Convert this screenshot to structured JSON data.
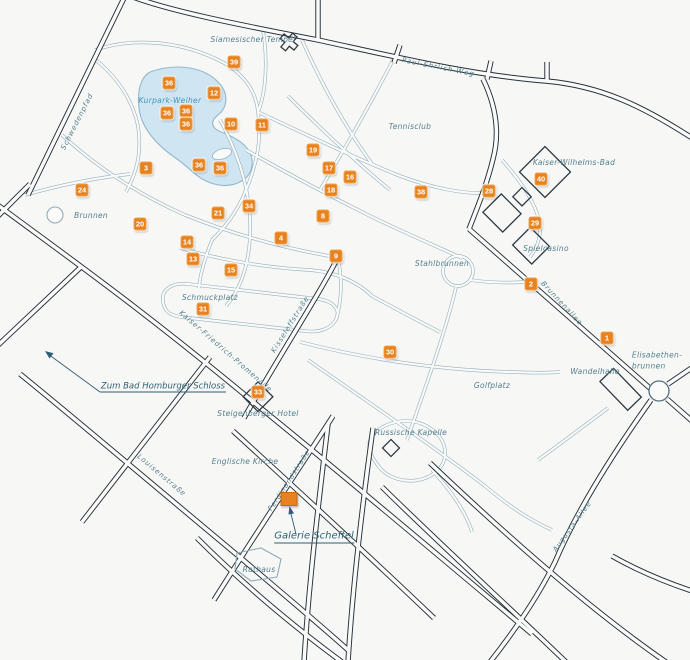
{
  "map": {
    "region_name": "Kurpark Bad Homburg map",
    "colors": {
      "background": "#f7f7f5",
      "road_main": "#25303a",
      "road_path": "#93b0bd",
      "road_fill": "#fafaf8",
      "lake_fill": "#cfe5f2",
      "lake_stroke": "#8fb9cf",
      "marker_background": "#e6821f",
      "marker_text": "#ffffff",
      "label_text": "#54808f",
      "water_label_text": "#4596ba",
      "link_text": "#2d6079"
    },
    "markers": [
      {
        "n": "36",
        "x": 169,
        "y": 83
      },
      {
        "n": "39",
        "x": 234,
        "y": 62
      },
      {
        "n": "12",
        "x": 214,
        "y": 93
      },
      {
        "n": "36",
        "x": 167,
        "y": 113
      },
      {
        "n": "36",
        "x": 186,
        "y": 111
      },
      {
        "n": "36",
        "x": 186,
        "y": 124
      },
      {
        "n": "10",
        "x": 231,
        "y": 124
      },
      {
        "n": "11",
        "x": 262,
        "y": 125
      },
      {
        "n": "3",
        "x": 146,
        "y": 168
      },
      {
        "n": "36",
        "x": 199,
        "y": 165
      },
      {
        "n": "36",
        "x": 220,
        "y": 168
      },
      {
        "n": "19",
        "x": 313,
        "y": 150
      },
      {
        "n": "17",
        "x": 329,
        "y": 168
      },
      {
        "n": "16",
        "x": 350,
        "y": 177
      },
      {
        "n": "18",
        "x": 331,
        "y": 190
      },
      {
        "n": "38",
        "x": 421,
        "y": 192
      },
      {
        "n": "24",
        "x": 82,
        "y": 190
      },
      {
        "n": "20",
        "x": 140,
        "y": 224
      },
      {
        "n": "21",
        "x": 218,
        "y": 213
      },
      {
        "n": "34",
        "x": 249,
        "y": 206
      },
      {
        "n": "8",
        "x": 323,
        "y": 216
      },
      {
        "n": "4",
        "x": 281,
        "y": 238
      },
      {
        "n": "14",
        "x": 187,
        "y": 242
      },
      {
        "n": "13",
        "x": 193,
        "y": 259
      },
      {
        "n": "15",
        "x": 231,
        "y": 270
      },
      {
        "n": "9",
        "x": 336,
        "y": 256
      },
      {
        "n": "31",
        "x": 203,
        "y": 309
      },
      {
        "n": "28",
        "x": 489,
        "y": 191
      },
      {
        "n": "40",
        "x": 541,
        "y": 179
      },
      {
        "n": "29",
        "x": 535,
        "y": 223
      },
      {
        "n": "2",
        "x": 531,
        "y": 284
      },
      {
        "n": "1",
        "x": 607,
        "y": 338
      },
      {
        "n": "30",
        "x": 390,
        "y": 352
      },
      {
        "n": "33",
        "x": 258,
        "y": 392
      }
    ],
    "labels": [
      {
        "id": "siamesischer-tempel",
        "text": "Siamesischer Tempel",
        "x": 253,
        "y": 40
      },
      {
        "id": "paul-ehrlich-weg",
        "text": "Paul-Ehrlich-Weg",
        "x": 438,
        "y": 68,
        "rotate": 11,
        "cls": "street"
      },
      {
        "id": "kurpark-weiher",
        "text": "Kurpark-Weiher",
        "x": 170,
        "y": 101,
        "cls": "water"
      },
      {
        "id": "tennisclub",
        "text": "Tennisclub",
        "x": 410,
        "y": 127
      },
      {
        "id": "kaiser-wilhelms-bad",
        "text": "Kaiser-Wilhelms-Bad",
        "x": 574,
        "y": 163
      },
      {
        "id": "schwedenpfad",
        "text": "Schwedenpfad",
        "x": 78,
        "y": 122,
        "rotate": -63,
        "cls": "street"
      },
      {
        "id": "brunnen",
        "text": "Brunnen",
        "x": 91,
        "y": 216
      },
      {
        "id": "spielcasino",
        "text": "Spielcasino",
        "x": 546,
        "y": 249
      },
      {
        "id": "stahlbrunnen",
        "text": "Stahlbrunnen",
        "x": 442,
        "y": 264
      },
      {
        "id": "brunnenallee",
        "text": "Brunnenallee",
        "x": 561,
        "y": 304,
        "rotate": 47,
        "cls": "street"
      },
      {
        "id": "elisabethenbrunnen",
        "text": "Elisabethen-\nbrunnen",
        "x": 657,
        "y": 361,
        "cls": "align-left"
      },
      {
        "id": "wandelhalle",
        "text": "Wandelhalle",
        "x": 595,
        "y": 372
      },
      {
        "id": "golfplatz",
        "text": "Golfplatz",
        "x": 492,
        "y": 386
      },
      {
        "id": "schmuckplatz",
        "text": "Schmuckplatz",
        "x": 210,
        "y": 298
      },
      {
        "id": "kaiser-friedrich-promenade",
        "text": "Kaiser-Friedrich-Promenade",
        "x": 225,
        "y": 352,
        "rotate": 41,
        "cls": "street"
      },
      {
        "id": "kisseleffstrasse",
        "text": "Kisseleffstraße",
        "x": 291,
        "y": 325,
        "rotate": -58,
        "cls": "street"
      },
      {
        "id": "steigenberger-hotel",
        "text": "Steigenberger Hotel",
        "x": 258,
        "y": 414
      },
      {
        "id": "russische-kapelle",
        "text": "Russische Kapelle",
        "x": 411,
        "y": 433
      },
      {
        "id": "englische-kirche",
        "text": "Englische Kirche",
        "x": 245,
        "y": 462
      },
      {
        "id": "ferdinandstrasse",
        "text": "Ferdinandstraße",
        "x": 290,
        "y": 481,
        "rotate": -57,
        "cls": "street"
      },
      {
        "id": "louisenstrasse",
        "text": "Louisenstraße",
        "x": 161,
        "y": 476,
        "rotate": 40,
        "cls": "street"
      },
      {
        "id": "augusta-allee",
        "text": "Augusta-Allee",
        "x": 573,
        "y": 527,
        "rotate": -54,
        "cls": "street"
      },
      {
        "id": "rathaus",
        "text": "Rathaus",
        "x": 259,
        "y": 570
      }
    ],
    "links": [
      {
        "id": "zum-bad-homburger-schloss",
        "text": "Zum Bad Homburger Schloss",
        "x": 163,
        "y": 387,
        "size": 8.5,
        "underline": false
      },
      {
        "id": "galerie-scheffel",
        "text": "Galerie Scheffel",
        "x": 314,
        "y": 537,
        "size": 10,
        "underline": true
      }
    ],
    "highlight": {
      "id": "galerie-scheffel-location",
      "x": 289,
      "y": 499,
      "w": 15,
      "h": 12
    }
  }
}
